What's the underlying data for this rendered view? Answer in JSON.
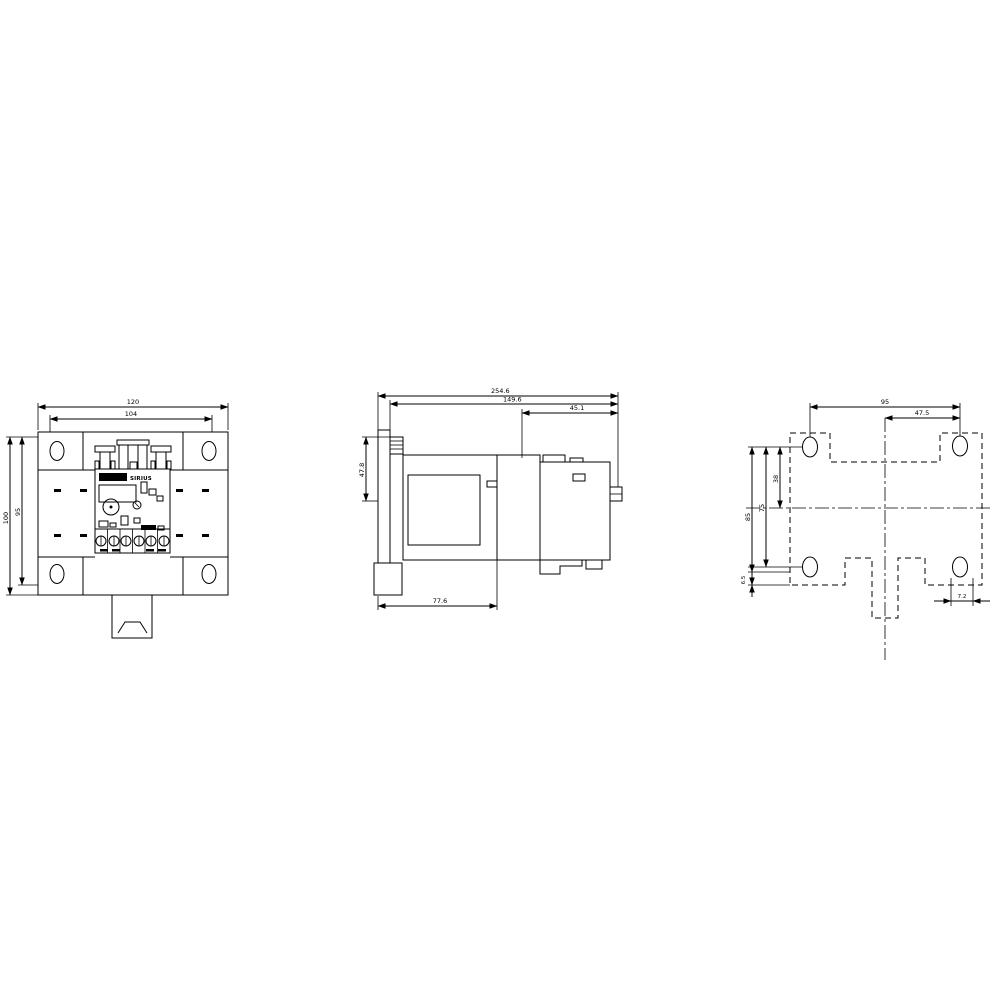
{
  "drawing": {
    "brand": "SIRIUS",
    "front_view": {
      "dim_width_outer": "120",
      "dim_width_inner": "104",
      "dim_height_outer": "100",
      "dim_height_inner": "95"
    },
    "side_view": {
      "dim_depth_total": "254.6",
      "dim_depth_body": "149.6",
      "dim_depth_head": "45.1",
      "dim_height_rail": "47.8",
      "dim_depth_base": "77.6"
    },
    "drilling_plan": {
      "dim_hole_spacing_h": "95",
      "dim_hole_center_h": "47.5",
      "dim_height_outer": "85",
      "dim_hole_spacing_v": "75",
      "dim_hole_center_v": "38",
      "dim_edge_offset": "6.5",
      "dim_slot_width": "7.2"
    }
  }
}
